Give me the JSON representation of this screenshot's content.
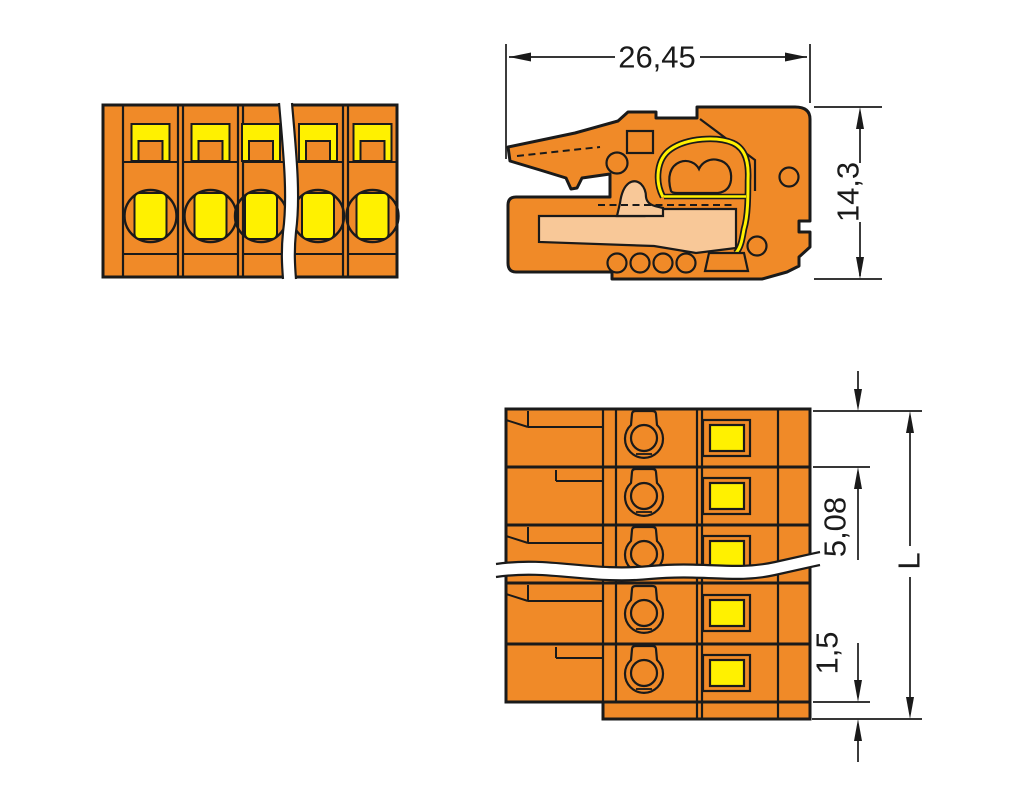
{
  "drawing": {
    "views": {
      "front": {
        "name": "front-view",
        "poles_shown": 5
      },
      "side_section": {
        "name": "side-view-cross-section"
      },
      "top": {
        "name": "top-view",
        "poles_shown": 5
      }
    },
    "dimensions": {
      "overall_depth": "26,45",
      "overall_height": "14,3",
      "pole_pitch": "5,08",
      "flange_thickness": "1,5",
      "total_length": "L"
    },
    "colors": {
      "housing_orange": "#F08A28",
      "lever_yellow": "#FFF100",
      "funnel_peach": "#F8C898",
      "outline": "#1A1A1A",
      "background": "#FFFFFF"
    }
  }
}
